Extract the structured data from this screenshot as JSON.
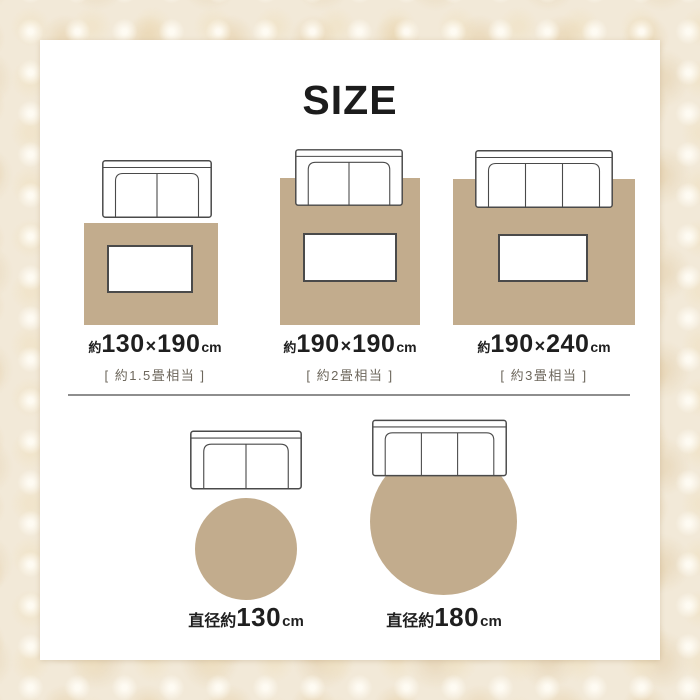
{
  "title": "SIZE",
  "colors": {
    "rug_beige": "#c2ac8d",
    "card_background": "#ffffff",
    "outline_gray": "#4a4a4a",
    "text_primary": "#1f1f1f",
    "text_secondary": "#6d675c",
    "divider_gray": "#8e8e8e",
    "page_background": "#f2e9d8"
  },
  "top_row": [
    {
      "prefix": "約",
      "width": "130",
      "times": "×",
      "depth": "190",
      "unit": "cm",
      "tatami": "[ 約1.5畳相当 ]"
    },
    {
      "prefix": "約",
      "width": "190",
      "times": "×",
      "depth": "190",
      "unit": "cm",
      "tatami": "[ 約2畳相当 ]"
    },
    {
      "prefix": "約",
      "width": "190",
      "times": "×",
      "depth": "240",
      "unit": "cm",
      "tatami": "[ 約3畳相当 ]"
    }
  ],
  "bottom_row": [
    {
      "prefix": "直径約",
      "diameter": "130",
      "unit": "cm"
    },
    {
      "prefix": "直径約",
      "diameter": "180",
      "unit": "cm"
    }
  ]
}
